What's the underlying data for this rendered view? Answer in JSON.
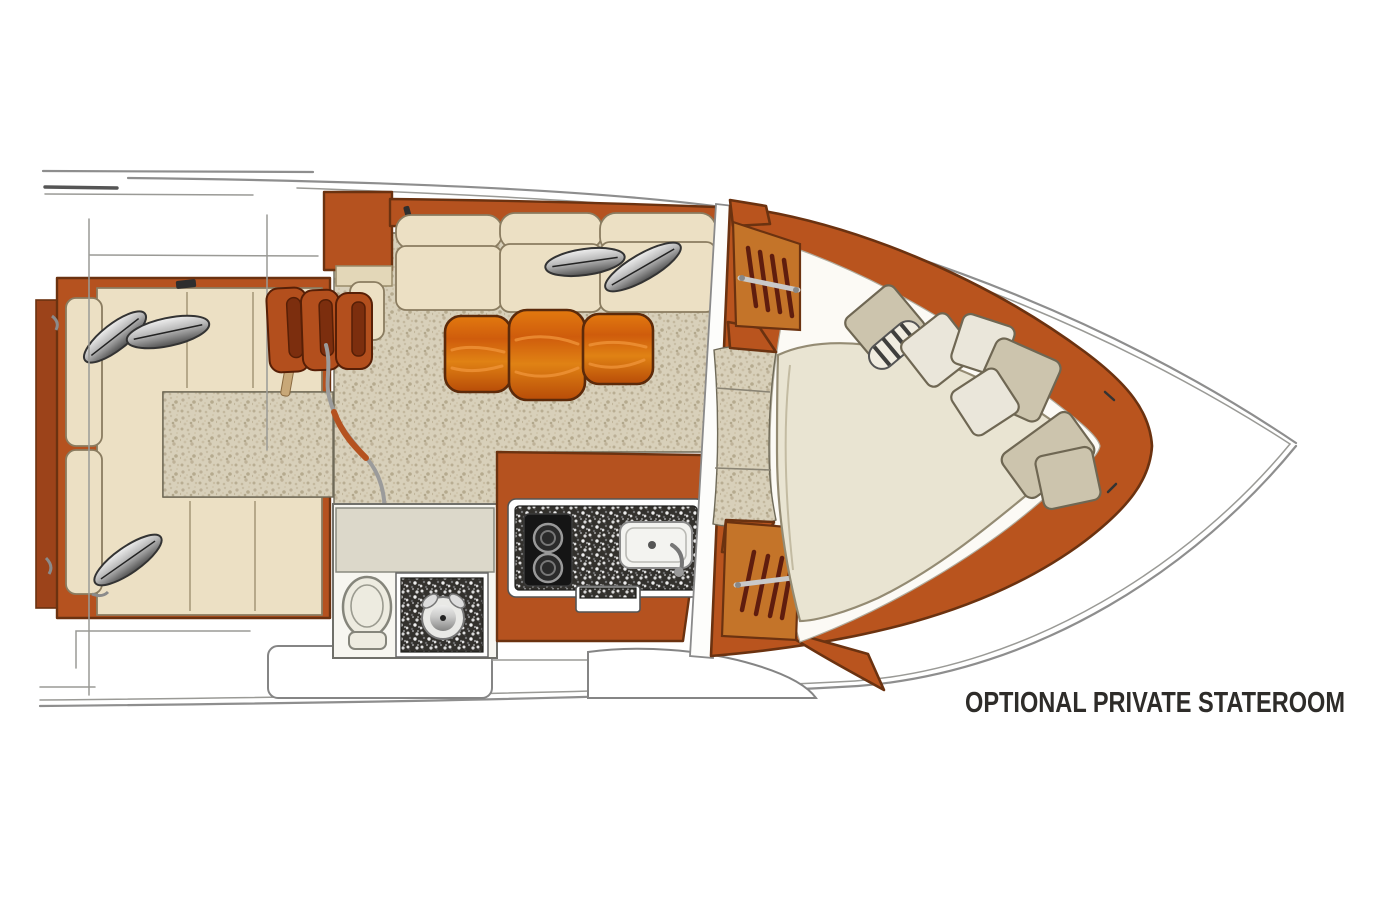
{
  "diagram": {
    "type": "yacht-interior-floorplan-plan-view-bow-right",
    "annotation": "OPTIONAL PRIVATE STATEROOM"
  },
  "colors": {
    "wall-orange": "#b5521f",
    "ring-orange": "#b9541e",
    "wall-rust": "#9c431a",
    "wall-amber": "#c47429",
    "slat-red": "#5f1d0e",
    "table-wood": "#cf5c0c",
    "upholstery-cream": "#ece0c4",
    "bed-ivory": "#e9e4d2",
    "pillow-beige": "#ccc4ad",
    "pillow-white": "#eae6da",
    "carpet-beige": "#d8d0ba",
    "granite-dark": "#33312d",
    "hull-gray": "#8e8e8e",
    "outline-dark": "#6b3210",
    "text-dark": "#2e2c29"
  }
}
